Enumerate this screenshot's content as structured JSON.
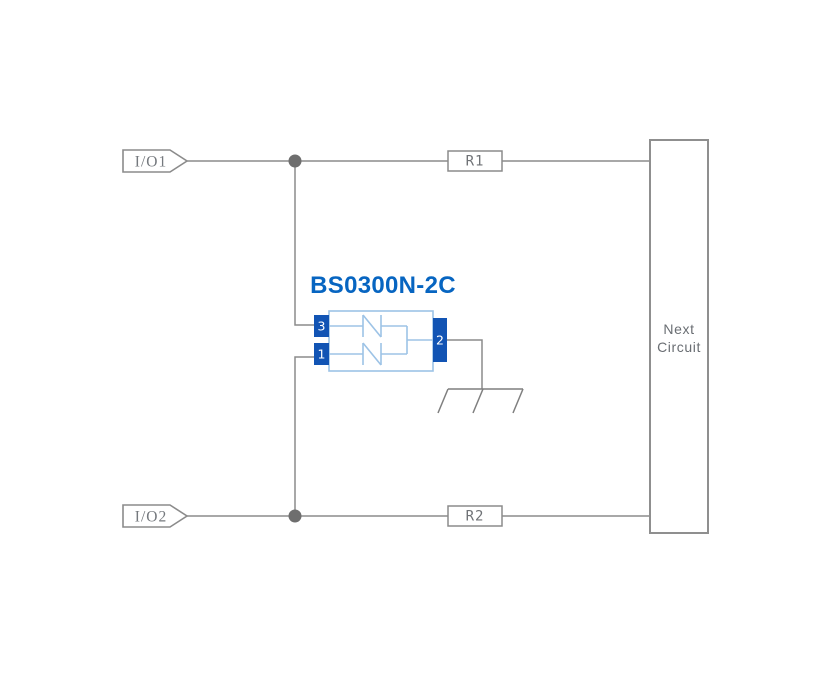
{
  "schematic": {
    "part_label": "BS0300N-2C",
    "io_connectors": {
      "top": "I/O1",
      "bottom": "I/O2"
    },
    "resistors": {
      "top": "R1",
      "bottom": "R2"
    },
    "tvs_component": {
      "pin_top_left": "3",
      "pin_bottom_left": "1",
      "pin_right": "2"
    },
    "next_circuit": {
      "line1": "Next",
      "line2": "Circuit"
    },
    "colors": {
      "wire_gray": "#8B8B8B",
      "junction_gray": "#6E6E6E",
      "pin_blue": "#1254B4",
      "component_outline_blue": "#9DC3E6",
      "part_label_blue": "#0765C1",
      "label_gray": "#6F7276"
    }
  }
}
